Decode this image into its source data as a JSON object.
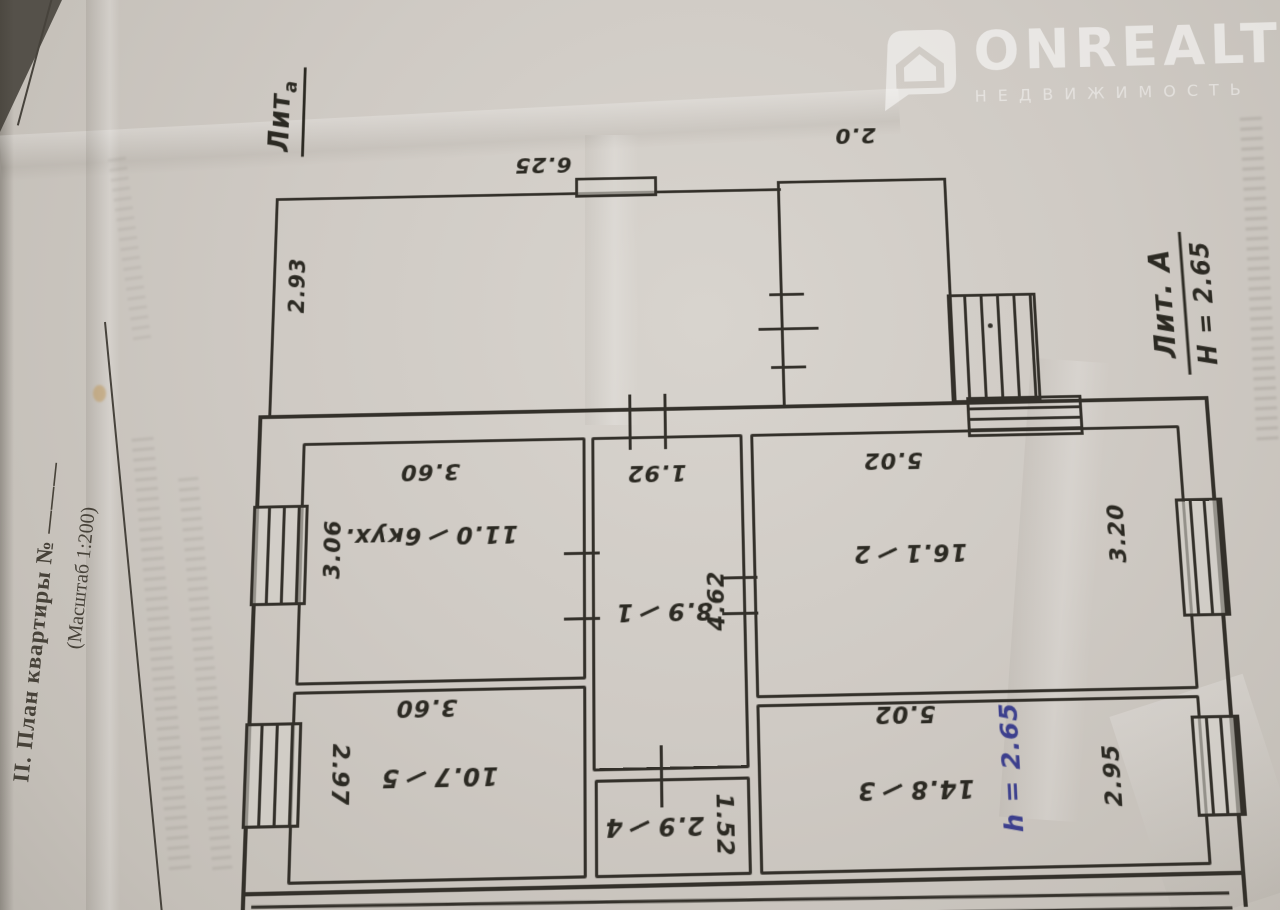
{
  "watermark": {
    "brand": "ONREALT",
    "subtitle": "НЕДВИЖИМОСТЬ"
  },
  "form": {
    "section_title": "II. План квартиры №",
    "number_blank": "———",
    "scale_note": "(Масштаб 1:200)"
  },
  "annotations": {
    "outbuilding_litera": "Лит",
    "outbuilding_litera_sub": "а",
    "main_litera": "Лит. А",
    "main_height": "Н = 2.65",
    "room3_height_note": "h = 2.65"
  },
  "exterior_dims": {
    "veranda_width": "6.25",
    "veranda_depth": "2.93",
    "annex_width": "2.0"
  },
  "rooms": [
    {
      "number": "1",
      "area": "8.9",
      "dim_horizontal": "1.92",
      "dim_vertical": "4.62"
    },
    {
      "number": "2",
      "area": "16.1",
      "dim_horizontal": "5.02",
      "dim_vertical": "3.20"
    },
    {
      "number": "3",
      "area": "14.8",
      "dim_horizontal": "5.02",
      "dim_vertical": "2.95"
    },
    {
      "number": "4",
      "area": "2.9",
      "dim_vertical": "1.52"
    },
    {
      "number": "5",
      "area": "10.7",
      "dim_horizontal": "3.60",
      "dim_vertical": "2.97"
    },
    {
      "number": "6кух.",
      "area": "11.0",
      "dim_horizontal": "3.60",
      "dim_vertical": "3.06"
    }
  ],
  "colors": {
    "ink": "#33302a",
    "blue_ink": "#3c3f8d",
    "paper": "#cfcac4"
  }
}
